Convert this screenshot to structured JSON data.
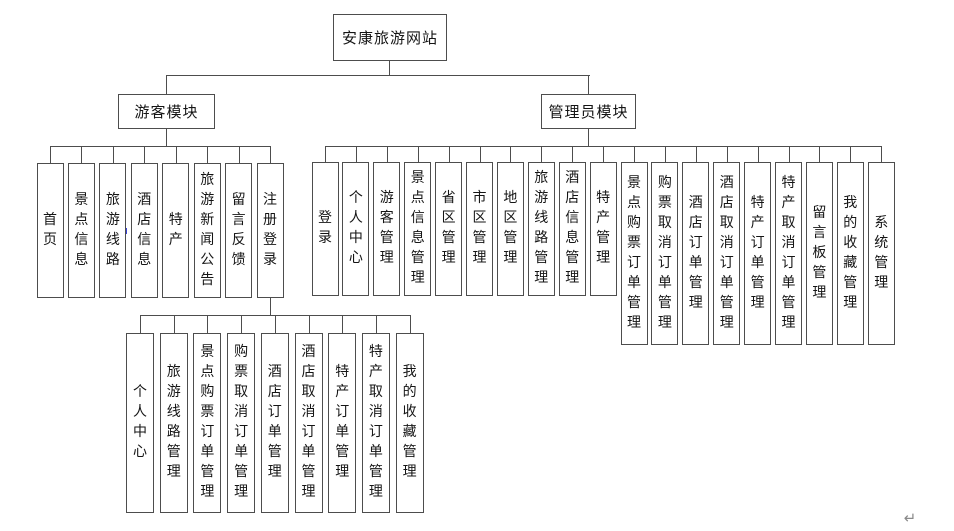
{
  "title": "安康旅游网站",
  "modules": [
    {
      "label": "游客模块",
      "children": [
        "首页",
        "景点信息",
        "旅游线路",
        "酒店信息",
        "特产",
        "旅游新闻公告",
        "留言反馈",
        "注册登录"
      ]
    },
    {
      "label": "管理员模块",
      "children": [
        "登录",
        "个人中心",
        "游客管理",
        "景点信息管理",
        "省区管理",
        "市区管理",
        "地区管理",
        "旅游线路管理",
        "酒店信息管理",
        "特产管理",
        "景点购票订单管理",
        "购票取消订单管理",
        "酒店订单管理",
        "酒店取消订单管理",
        "特产订单管理",
        "特产取消订单管理",
        "留言板管理",
        "我的收藏管理",
        "系统管理"
      ]
    }
  ],
  "register_login_children": [
    "个人中心",
    "旅游线路管理",
    "景点购票订单管理",
    "购票取消订单管理",
    "酒店订单管理",
    "酒店取消订单管理",
    "特产订单管理",
    "特产取消订单管理",
    "我的收藏管理"
  ],
  "marks": {
    "return_mark": "↵"
  },
  "colors": {
    "line": "#4d4d4d",
    "text": "#151515",
    "artifact_blue": "#3a45d8",
    "return_gray": "#8a8a8a"
  }
}
